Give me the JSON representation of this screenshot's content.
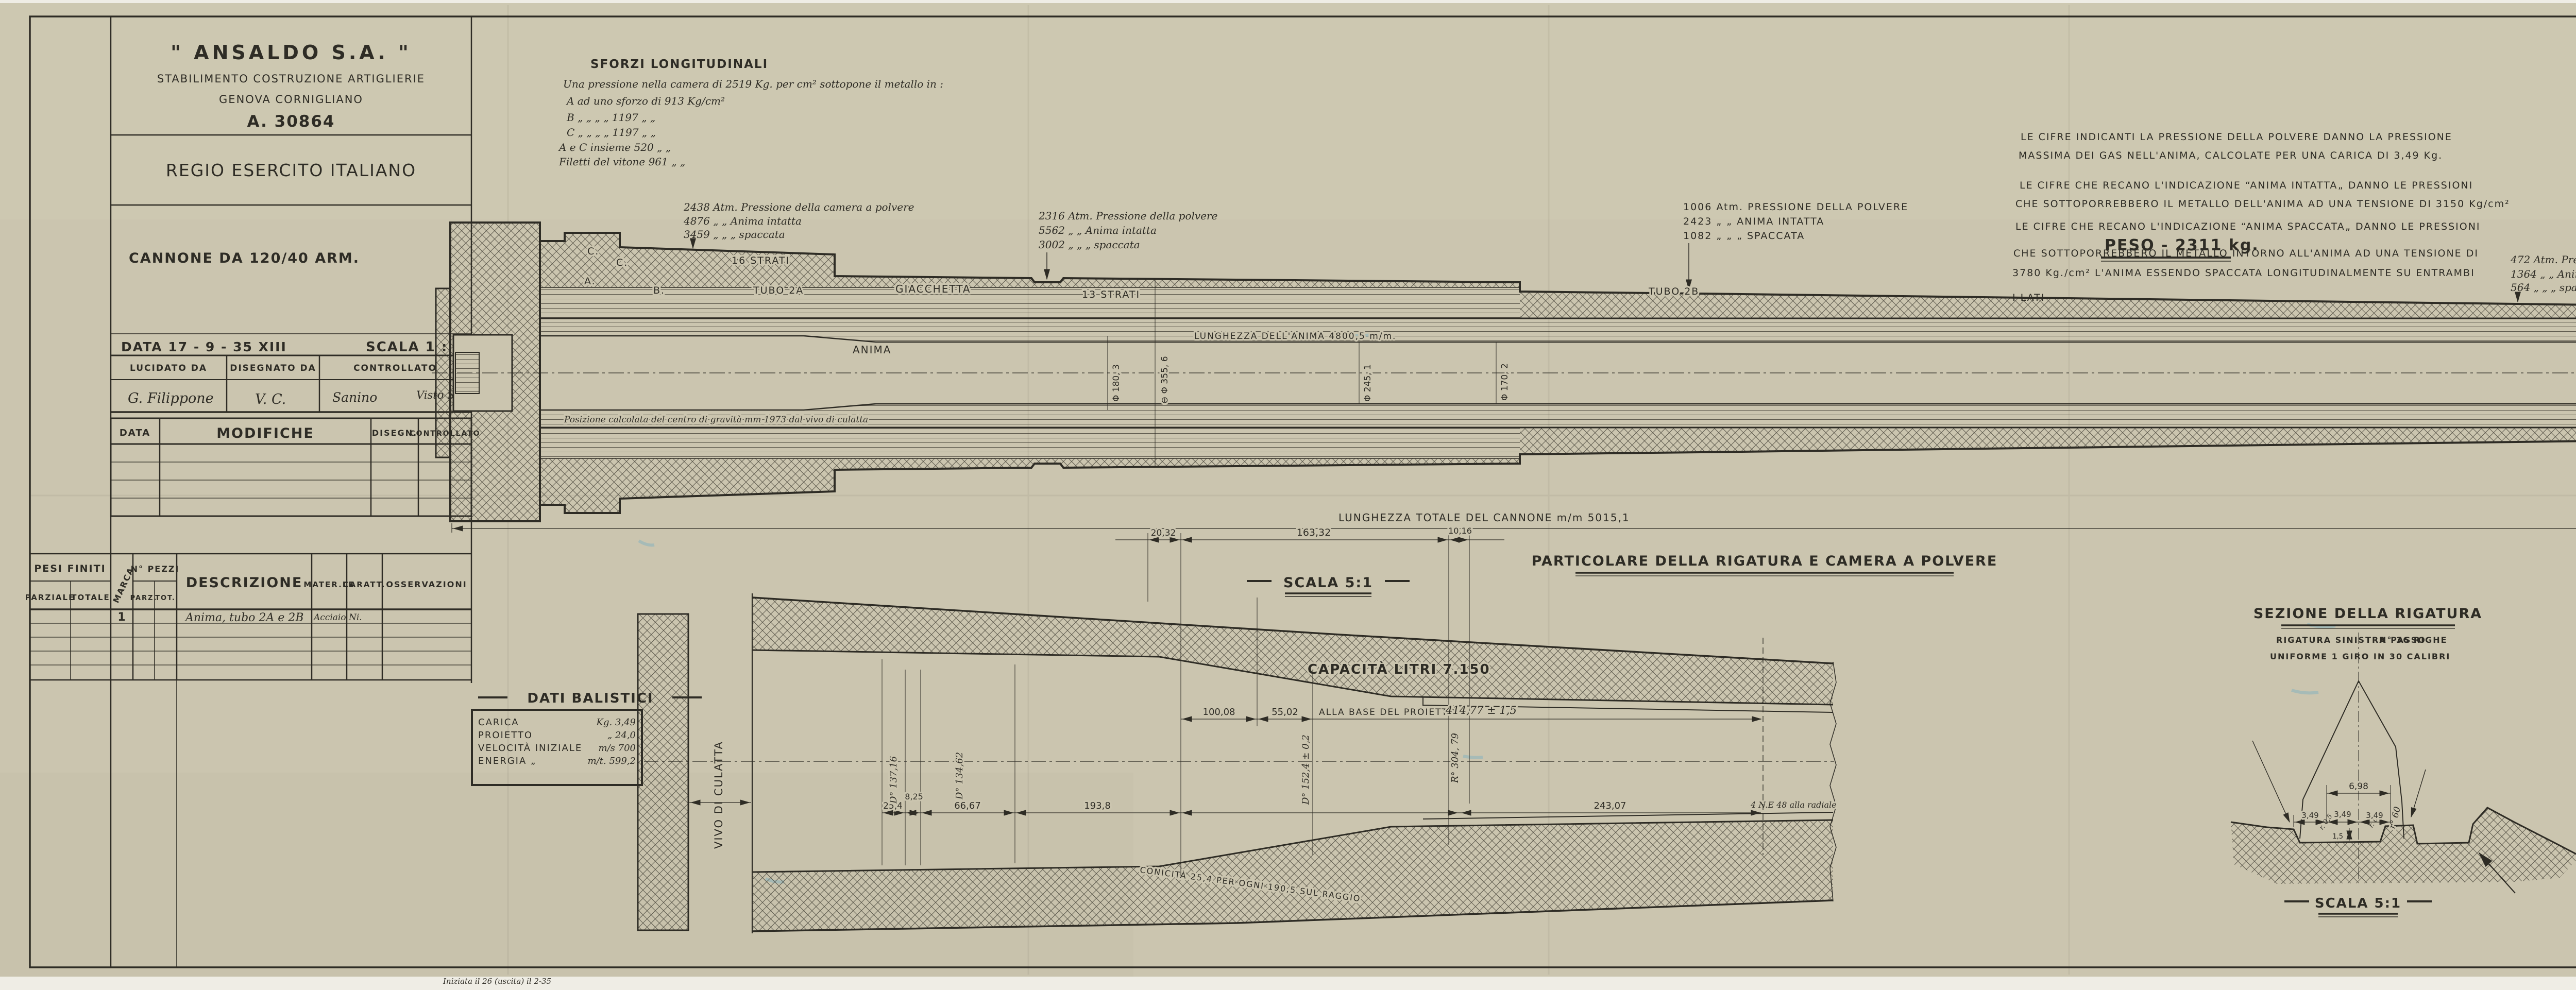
{
  "sheet": {
    "paper": "#cbc5af",
    "ink": "#2e2c25"
  },
  "title_block": {
    "company": "\" ANSALDO  S.A. \"",
    "dept": "STABILIMENTO COSTRUZIONE ARTIGLIERIE",
    "city": "GENOVA  CORNIGLIANO",
    "number": "A. 30864",
    "client": "REGIO  ESERCITO  ITALIANO",
    "subject": "CANNONE DA 120/40  ARM.",
    "date": "DATA 17 - 9 - 35 XIII",
    "scale": "SCALA 1 : 4",
    "col_lucidato": "LUCIDATO  DA",
    "col_disegnato": "DISEGNATO  DA",
    "col_controllato": "CONTROLLATO",
    "sig_lucidato": "G. Filippone",
    "sig_disegnato": "V. C.",
    "sig_controllato_1": "Sanino",
    "sig_controllato_2": "Visto S.B.",
    "mod_data": "DATA",
    "mod_title": "MODIFICHE",
    "mod_disegn": "DISEGN.",
    "mod_contr": "CONTROLLATO"
  },
  "parts_table": {
    "pesi_finiti": "PESI FINITI",
    "parziale": "PARZIALE",
    "totale": "TOTALE",
    "marca": "MARCA",
    "n_pezzi": "N° PEZZI",
    "parz": "PARZ.",
    "tot": "TOT.",
    "descrizione": "DESCRIZIONE",
    "materiale": "MATER.LE",
    "caratt": "CARATT.",
    "osservazioni": "OSSERVAZIONI",
    "row1": {
      "marca": "1",
      "descrizione": "Anima, tubo 2A e 2B",
      "materiale": "Acciaio Ni."
    }
  },
  "sforzi_note": {
    "title": "SFORZI  LONGITUDINALI",
    "l1": "Una pressione nella camera di 2519 Kg. per cm² sottopone il metallo in :",
    "l2": "A    ad uno sforzo di    913  Kg/cm²",
    "l3": "B    „     „     „       „  1197   „    „",
    "l4": "C    „     „     „       „  1197   „    „",
    "l5": "A e C insieme             520   „    „",
    "l6": "Filetti del vitone            961   „    „"
  },
  "legend_note": {
    "l1": "LE CIFRE INDICANTI LA PRESSIONE DELLA POLVERE DANNO LA PRESSIONE",
    "l2": "MASSIMA DEI GAS NELL'ANIMA, CALCOLATE PER UNA CARICA DI 3,49 Kg.",
    "l3": "LE CIFRE CHE RECANO L'INDICAZIONE “ANIMA INTATTA„ DANNO LE PRESSIONI",
    "l4": "CHE SOTTOPORREBBERO IL METALLO DELL'ANIMA AD UNA TENSIONE DI 3150 Kg/cm²",
    "l5": "LE CIFRE CHE RECANO L'INDICAZIONE “ANIMA SPACCATA„ DANNO LE PRESSIONI",
    "l6": "CHE SOTTOPORREBBERO IL METALLO INTORNO ALL'ANIMA AD UNA TENSIONE DI",
    "l7": "3780 Kg./cm² L'ANIMA ESSENDO SPACCATA LONGITUDINALMENTE SU ENTRAMBI",
    "l8": "I LATI"
  },
  "peso": "PESO - 2311 kg.",
  "callouts": {
    "c1": {
      "l1": "2438  Atm.  Pressione della camera a polvere",
      "l2": "4876    „          „         Anima intatta",
      "l3": "3459    „          „            „    spaccata"
    },
    "c2": {
      "l1": "2316  Atm.  Pressione della polvere",
      "l2": "5562    „          „         Anima intatta",
      "l3": "3002    „          „            „    spaccata"
    },
    "c3": {
      "l1": "1006  Atm.  PRESSIONE  DELLA  POLVERE",
      "l2": "2423    „         „         ANIMA  INTATTA",
      "l3": "1082    „         „            „      SPACCATA"
    },
    "c4": {
      "l1": "472  Atm.  Pressione della polvere",
      "l2": "1364   „         „        Anima intatta",
      "l3": "564   „         „           „    spaccata"
    }
  },
  "main_view": {
    "labels": {
      "c_upper": "C.",
      "c_lower": "C.",
      "a": "A.",
      "b": "B.",
      "strati16": "16 STRATI",
      "tubo2a": "TUBO 2A",
      "giacchetta": "GIACCHETTA",
      "strati13": "13 STRATI",
      "anima": "ANIMA",
      "tubo2b": "TUBO 2B"
    },
    "bore_length": "LUNGHEZZA  DELL'ANIMA  4800,5 m/m.",
    "total_length": "LUNGHEZZA  TOTALE   DEL  CANNONE  m/m  5015,1",
    "cg_note": "Posizione calcolata del centro di gravità mm 1973 dal vivo di culatta",
    "dia": {
      "d1": "Φ 180, 3",
      "d2": "⊖ Φ 355, 6",
      "d3": "Φ 245, 1",
      "d4": "Φ 170, 2"
    }
  },
  "detail_view": {
    "title": "PARTICOLARE  DELLA  RIGATURA  E  CAMERA  A  POLVERE",
    "scale_label": "SCALA  5:1",
    "capacity": "CAPACITÀ  LITRI  7.150",
    "vivo": "VIVO  DI  CULATTA",
    "base_label": "ALLA BASE  DEL PROIETTO",
    "base_value": "414,77 ± 1,5",
    "conicity": "CONICITÀ 25,4  PER OGNI 190,5  SUL RAGGIO",
    "end_note": "4 N.E 48 alla radiale",
    "dims": {
      "d2032": "20,32",
      "d16332": "163,32",
      "d1016": "10,16",
      "d10008": "100,08",
      "d5502": "55,02",
      "d254": "25,4",
      "d825": "8,25",
      "d6667": "66,67",
      "d1938": "193,8",
      "d24307": "243,07"
    },
    "dia": {
      "r304": "R° 304, 79",
      "d13716": "D° 137,16",
      "d13462": "D° 134,62",
      "d1524": "D° 152,4 ± 0,2"
    }
  },
  "rifling_section": {
    "title": "SEZIONE  DELLA  RIGATURA",
    "note1": "RIGATURA  SINISTRA  PASSO",
    "note2": "UNIFORME  1 GIRO IN 30 CALIBRI",
    "note3": "N° 36  RIGHE",
    "scale_label": "SCALA  5:1",
    "dims": {
      "w698": "6,98",
      "w349a": "3,49",
      "w349b": "3,49",
      "w349c": "3,49",
      "r60": "r° 60",
      "r05a": "r. 0,5",
      "r05b": "r. 0,5",
      "depth": "1,5"
    }
  },
  "footer": {
    "number": "A. 30864",
    "note": "Iniziata il 26 (uscita) il 2-35"
  }
}
